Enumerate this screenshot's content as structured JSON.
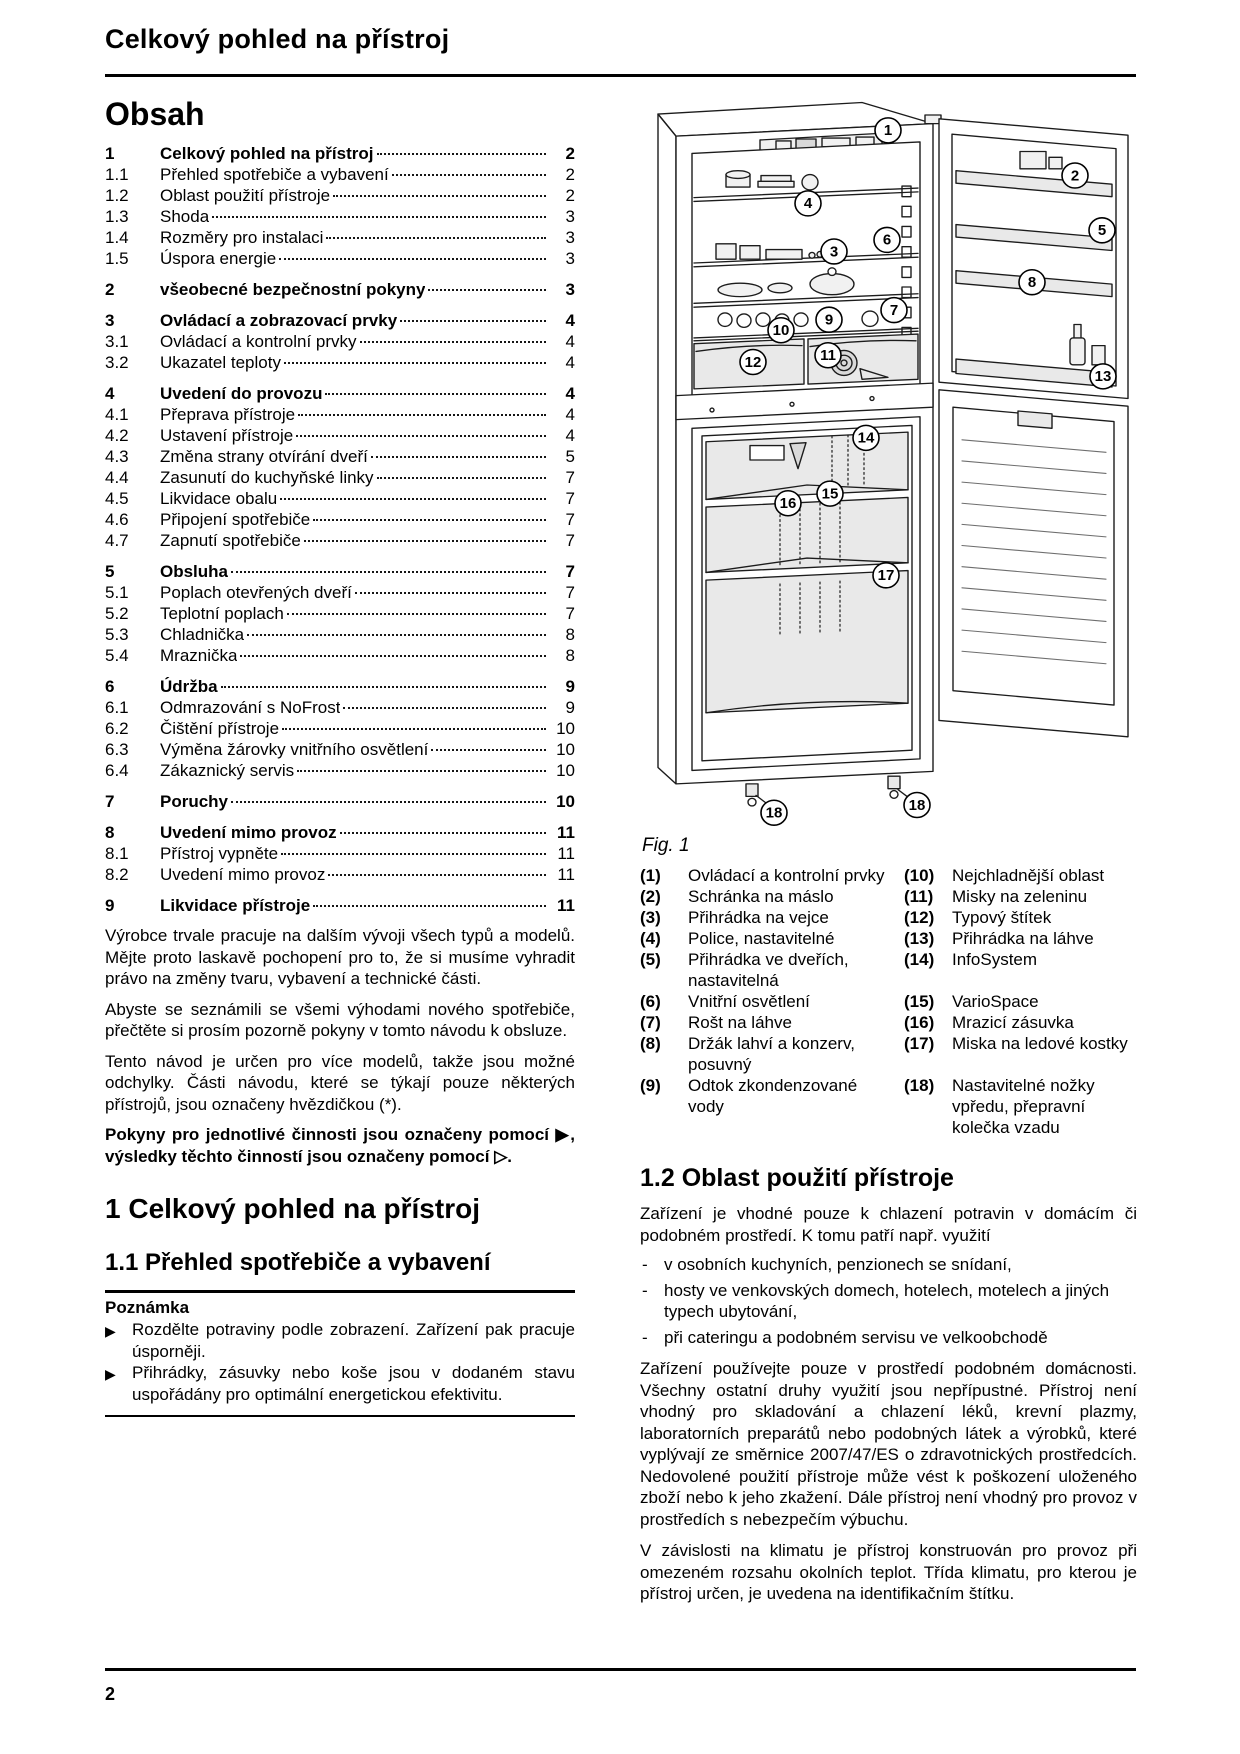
{
  "header": {
    "title": "Celkový pohled na přístroj"
  },
  "footer": {
    "page_number": "2"
  },
  "symbols": {
    "action_marker": "▶",
    "dash_marker": "-"
  },
  "toc": {
    "heading": "Obsah",
    "entries": [
      {
        "num": "1",
        "title": "Celkový pohled na přístroj",
        "page": "2",
        "bold": true
      },
      {
        "num": "1.1",
        "title": "Přehled spotřebiče a vybavení",
        "page": "2"
      },
      {
        "num": "1.2",
        "title": "Oblast použití přístroje",
        "page": "2"
      },
      {
        "num": "1.3",
        "title": "Shoda",
        "page": "3"
      },
      {
        "num": "1.4",
        "title": "Rozměry pro instalaci",
        "page": "3"
      },
      {
        "num": "1.5",
        "title": "Úspora energie",
        "page": "3"
      },
      {
        "num": "2",
        "title": "všeobecné bezpečnostní pokyny",
        "page": "3",
        "bold": true
      },
      {
        "num": "3",
        "title": "Ovládací a zobrazovací prvky",
        "page": "4",
        "bold": true
      },
      {
        "num": "3.1",
        "title": "Ovládací a kontrolní prvky",
        "page": "4"
      },
      {
        "num": "3.2",
        "title": "Ukazatel teploty",
        "page": "4"
      },
      {
        "num": "4",
        "title": "Uvedení do provozu",
        "page": "4",
        "bold": true
      },
      {
        "num": "4.1",
        "title": "Přeprava přístroje",
        "page": "4"
      },
      {
        "num": "4.2",
        "title": "Ustavení přístroje",
        "page": "4"
      },
      {
        "num": "4.3",
        "title": "Změna strany otvírání dveří",
        "page": "5"
      },
      {
        "num": "4.4",
        "title": "Zasunutí do kuchyňské linky",
        "page": "7"
      },
      {
        "num": "4.5",
        "title": "Likvidace obalu",
        "page": "7"
      },
      {
        "num": "4.6",
        "title": "Připojení spotřebiče",
        "page": "7"
      },
      {
        "num": "4.7",
        "title": "Zapnutí spotřebiče",
        "page": "7"
      },
      {
        "num": "5",
        "title": "Obsluha",
        "page": "7",
        "bold": true
      },
      {
        "num": "5.1",
        "title": "Poplach otevřených dveří",
        "page": "7"
      },
      {
        "num": "5.2",
        "title": "Teplotní poplach",
        "page": "7"
      },
      {
        "num": "5.3",
        "title": "Chladnička",
        "page": "8"
      },
      {
        "num": "5.4",
        "title": "Mraznička",
        "page": "8"
      },
      {
        "num": "6",
        "title": "Údržba",
        "page": "9",
        "bold": true
      },
      {
        "num": "6.1",
        "title": "Odmrazování s NoFrost",
        "page": "9"
      },
      {
        "num": "6.2",
        "title": "Čištění přístroje",
        "page": "10"
      },
      {
        "num": "6.3",
        "title": "Výměna žárovky vnitřního osvětlení",
        "page": "10"
      },
      {
        "num": "6.4",
        "title": "Zákaznický servis",
        "page": "10"
      },
      {
        "num": "7",
        "title": "Poruchy",
        "page": "10",
        "bold": true
      },
      {
        "num": "8",
        "title": "Uvedení mimo provoz",
        "page": "11",
        "bold": true
      },
      {
        "num": "8.1",
        "title": "Přístroj vypněte",
        "page": "11"
      },
      {
        "num": "8.2",
        "title": "Uvedení mimo provoz",
        "page": "11"
      },
      {
        "num": "9",
        "title": "Likvidace přístroje",
        "page": "11",
        "bold": true
      }
    ]
  },
  "intro": {
    "paragraphs": [
      "Výrobce trvale pracuje na dalším vývoji všech typů a modelů. Mějte proto laskavě pochopení pro to, že si musíme vyhradit právo na změny tvaru, vybavení a technické části.",
      "Abyste se seznámili se všemi výhodami nového spotřebiče, přečtěte si prosím pozorně pokyny v tomto návodu k obsluze.",
      "Tento návod je určen pro více modelů, takže jsou možné odchylky. Části návodu, které se týkají pouze některých přístrojů, jsou označeny hvězdičkou (*)."
    ],
    "bold_paragraph": "Pokyny pro jednotlivé činnosti jsou označeny pomocí ▶, výsledky těchto činností jsou označeny pomocí ▷."
  },
  "section1": {
    "heading": "1 Celkový pohled na přístroj"
  },
  "section1_1": {
    "heading": "1.1 Přehled spotřebiče a vybavení",
    "note": {
      "title": "Poznámka",
      "bullets": [
        "Rozdělte potraviny podle zobrazení. Zařízení pak pracuje úsporněji.",
        "Přihrádky, zásuvky nebo koše jsou v dodaném stavu uspořádány pro optimální energetickou efektivitu."
      ]
    }
  },
  "figure": {
    "caption": "Fig. 1",
    "callouts": [
      "1",
      "2",
      "4",
      "5",
      "6",
      "3",
      "8",
      "7",
      "9",
      "10",
      "11",
      "12",
      "13",
      "14",
      "15",
      "16",
      "17",
      "18",
      "18"
    ]
  },
  "legend": {
    "rows": [
      {
        "l_num": "(1)",
        "l_text": "Ovládací a kontrolní prvky",
        "r_num": "(10)",
        "r_text": "Nejchladnější oblast"
      },
      {
        "l_num": "(2)",
        "l_text": "Schránka na máslo",
        "r_num": "(11)",
        "r_text": "Misky na zeleninu"
      },
      {
        "l_num": "(3)",
        "l_text": "Přihrádka na vejce",
        "r_num": "(12)",
        "r_text": "Typový štítek"
      },
      {
        "l_num": "(4)",
        "l_text": "Police, nastavitelné",
        "r_num": "(13)",
        "r_text": "Přihrádka na láhve"
      },
      {
        "l_num": "(5)",
        "l_text": "Přihrádka ve dveřích, nastavitelná",
        "r_num": "(14)",
        "r_text": "InfoSystem"
      },
      {
        "l_num": "(6)",
        "l_text": "Vnitřní osvětlení",
        "r_num": "(15)",
        "r_text": "VarioSpace"
      },
      {
        "l_num": "(7)",
        "l_text": "Rošt na láhve",
        "r_num": "(16)",
        "r_text": "Mrazicí zásuvka"
      },
      {
        "l_num": "(8)",
        "l_text": "Držák lahví a konzerv, posuvný",
        "r_num": "(17)",
        "r_text": "Miska na ledové kostky"
      },
      {
        "l_num": "(9)",
        "l_text": "Odtok zkondenzované vody",
        "r_num": "(18)",
        "r_text": "Nastavitelné nožky vpředu, přepravní kolečka vzadu"
      }
    ]
  },
  "section1_2": {
    "heading": "1.2 Oblast použití přístroje",
    "intro": "Zařízení je vhodné pouze k chlazení potravin v domácím či podobném prostředí. K tomu patří např. využití",
    "bullets": [
      "v osobních kuchyních, penzionech se snídaní,",
      "hosty ve venkovských domech, hotelech, motelech a jiných typech ubytování,",
      "při cateringu a podobném servisu ve velkoobchodě"
    ],
    "paragraphs": [
      "Zařízení používejte pouze v prostředí podobném domácnosti. Všechny ostatní druhy využití jsou nepřípustné. Přístroj není vhodný pro skladování a chlazení léků, krevní plazmy, laboratorních preparátů nebo podobných látek a výrobků, které vyplývají ze směrnice 2007/47/ES o zdravotnických prostředcích. Nedovolené použití přístroje může vést k poškození uloženého zboží nebo k jeho zkažení. Dále přístroj není vhodný pro provoz v prostředích s nebezpečím výbuchu.",
      "V závislosti na klimatu je přístroj konstruován pro provoz při omezeném rozsahu okolních teplot. Třída klimatu, pro kterou je přístroj určen, je uvedena na identifikačním štítku."
    ]
  }
}
